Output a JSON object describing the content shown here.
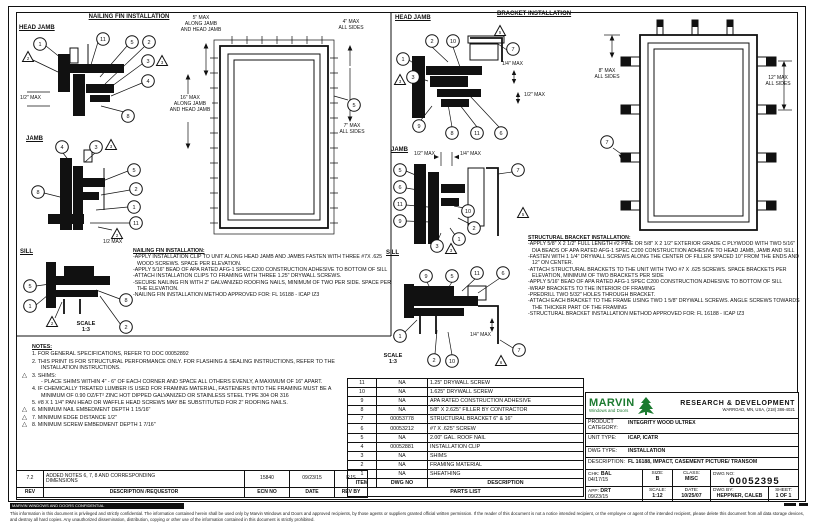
{
  "fin_section": {
    "title": "NAILING FIN INSTALLATION",
    "head_jamb_label": "HEAD JAMB",
    "jamb_label": "JAMB",
    "sill_label": "SILL",
    "scale_text": "SCALE\n1:3",
    "dims": {
      "hj_half": "1/2\" MAX",
      "j_half": "1/2 MAX",
      "elev_top": "5\" MAX\nALONG JAMB\nAND HEAD JAMB",
      "elev_left": "16\" MAX\nALONG JAMB\nAND HEAD JAMB",
      "elev_r1": "4\" MAX\nALL SIDES",
      "elev_r2": "7\" MAX\nALL SIDES"
    },
    "instructions_title": "NAILING FIN INSTALLATION:",
    "instructions": [
      "-APPLY INSTALLATION CLIP TO UNIT ALONG HEAD JAMB AND JAMBS FASTEN WITH THREE #7X .625 WOOD SCREWS. SPACE PER ELEVATION.",
      "-APPLY 5/16\" BEAD OF APA RATED AFG-1 SPEC C200 CONSTRUCTION ADHESIVE TO BOTTOM OF SILL",
      "-ATTACH INSTALLATION CLIPS TO FRAMING WITH THREE 1.25\" DRYWALL SCREWS.",
      "-SECURE NAILING FIN WITH 2\" GALVANIZED ROOFING NAILS, MINIMUM OF TWO PER SIDE. SPACE PER THE ELEVATION.",
      "-NAILING FIN INSTALLATION METHOD APPROVED FOR: FL 16188 - ICAP IZ3"
    ]
  },
  "bracket_section": {
    "title": "BRACKET INSTALLATION",
    "head_jamb_label": "HEAD JAMB",
    "jamb_label": "JAMB",
    "sill_label": "SILL",
    "scale_text": "SCALE\n1:3",
    "dims": {
      "hj_quarter": "1/4\" MAX",
      "hj_half": "1/2\" MAX",
      "j_half": "1/2\" MAX",
      "j_quarter": "1/4\" MAX",
      "s_quarter": "1/4\" MAX",
      "elev_left": "8\" MAX\nALL SIDES",
      "elev_right": "12\" MAX\nALL SIDES"
    },
    "instructions_title": "STRUCTURAL BRACKET INSTALLATION:",
    "instructions": [
      "-APPLY 5/8\" X 2 1/2\" FULL LENGTH #2 PINE OR 5/8\" X 2 1/2\" EXTERIOR GRADE C PLYWOOD WITH TWO 5/16\" DIA BEADS OF APA RATED AFG-1 SPEC C200 CONSTRUCTION ADHESIVE TO HEAD JAMB, JAMB AND SILL",
      "-FASTEN WITH 1 1/4\" DRYWALL SCREWS ALONG THE CENTER OF FILLER SPACED 10\" FROM THE ENDS AND 12\" ON CENTER.",
      "-ATTACH STRUCTURAL BRACKETS TO THE UNIT WITH TWO #7 X .625 SCREWS. SPACE BRACKETS PER ELEVATION, MINIMUM OF TWO BRACKETS PER SIDE",
      "-APPLY 5/16\" BEAD OF APA RATED AFG-1 SPEC C200 CONSTRUCTION ADHESIVE TO BOTTOM OF SILL",
      "-WRAP BRACKETS TO THE INTERIOR OF FRAMING",
      "-PREDRILL TWO 5/32\" HOLES THROUGH BRACKET.",
      "-ATTACH EACH BRACKET TO THE FRAME USING TWO 1 5/8\" DRYWALL SCREWS. ANGLE SCREWS TOWARDS THE THICKER PART OF THE FRAMING",
      "-STRUCTURAL BRACKET INSTALLATION METHOD APPROVED FOR: FL 16188 - ICAP IZ3"
    ]
  },
  "callouts": {
    "fin_head_jamb": [
      "2",
      "1",
      "11",
      "5",
      "2",
      "3",
      "3",
      "4",
      "8"
    ],
    "fin_jamb": [
      "4",
      "3",
      "3",
      "5",
      "2",
      "1",
      "11",
      "8",
      "2"
    ],
    "fin_sill": [
      "5",
      "1",
      "8",
      "2",
      "2"
    ],
    "fin_elev": [
      "5"
    ],
    "brk_head_jamb": [
      "5",
      "2",
      "10",
      "7",
      "1",
      "3",
      "3",
      "9",
      "8",
      "11",
      "6"
    ],
    "brk_jamb": [
      "5",
      "6",
      "11",
      "9",
      "3",
      "3",
      "1",
      "2",
      "10",
      "7",
      "5"
    ],
    "brk_sill": [
      "9",
      "5",
      "11",
      "6",
      "1",
      "2",
      "10",
      "7",
      "6"
    ],
    "brk_elev": [
      "7"
    ]
  },
  "notes": {
    "title": "NOTES:",
    "items": [
      {
        "flag": false,
        "text": "1. FOR GENERAL SPECIFICATIONS, REFER TO DOC 00052892"
      },
      {
        "flag": false,
        "text": "2. THIS PRINT IS FOR STRUCTURAL PERFORMANCE ONLY. FOR FLASHING & SEALING INSTRUCTIONS, REFER TO THE INSTALLATION INSTRUCTIONS."
      },
      {
        "flag": true,
        "text": "3. SHIMS:\n- PLACE SHIMS WITHIN 4\" - 6\" OF EACH CORNER AND SPACE ALL OTHERS EVENLY, A MAXIMUM OF 16\" APART."
      },
      {
        "flag": false,
        "text": "4. IF CHEMICALLY TREATED LUMBER IS USED FOR FRAMING MATERIAL, FASTENERS INTO THE FRAMING MUST BE A MINIMUM OF 0.90 OZ/FT² ZINC HOT DIPPED GALVANIZED OR STAINLESS STEEL TYPE 304 OR 316"
      },
      {
        "flag": false,
        "text": "5. #8 X 1 1/4\" PAN HEAD OR WAFFLE HEAD SCREWS MAY BE SUBSTITUTED FOR 2\" ROOFING NAILS."
      },
      {
        "flag": true,
        "text": "6. MINIMUM NAIL EMBEDMENT DEPTH 1 15/16\""
      },
      {
        "flag": true,
        "text": "7. MINIMUM EDGE DISTANCE 1/2\""
      },
      {
        "flag": true,
        "text": "8. MINIMUM SCREW EMBEDMENT DEPTH 1 7/16\""
      }
    ]
  },
  "parts_list": {
    "title": "PARTS LIST",
    "headers": {
      "item": "ITEM",
      "dwg": "DWG NO",
      "desc": "DESCRIPTION"
    },
    "rows": [
      {
        "item": "11",
        "dwg": "NA",
        "desc": "1.25\" DRYWALL SCREW"
      },
      {
        "item": "10",
        "dwg": "NA",
        "desc": "1.625\" DRYWALL SCREW"
      },
      {
        "item": "9",
        "dwg": "NA",
        "desc": "APA RATED CONSTRUCTION ADHESIVE"
      },
      {
        "item": "8",
        "dwg": "NA",
        "desc": "5/8\" X 2.625\" FILLER BY CONTRACTOR"
      },
      {
        "item": "7",
        "dwg": "00053778",
        "desc": "STRUCTURAL BRACKET 6\" & 16\""
      },
      {
        "item": "6",
        "dwg": "00053212",
        "desc": "#7 X .625\" SCREW"
      },
      {
        "item": "5",
        "dwg": "NA",
        "desc": "2.00\" GAL. ROOF NAIL"
      },
      {
        "item": "4",
        "dwg": "00052881",
        "desc": "INSTALLATION CLIP"
      },
      {
        "item": "3",
        "dwg": "NA",
        "desc": "SHIMS"
      },
      {
        "item": "2",
        "dwg": "NA",
        "desc": "FRAMING MATERIAL"
      },
      {
        "item": "1",
        "dwg": "NA",
        "desc": "SHEATHING"
      }
    ]
  },
  "title_block": {
    "company": {
      "name": "MARVIN",
      "tagline": "Windows and Doors",
      "dept": "RESEARCH & DEVELOPMENT",
      "address": "WARROAD, MN, USA, (218) 386-4021"
    },
    "product_label": "PRODUCT\nCATEGORY:",
    "product": "INTEGRITY WOOD ULTREX",
    "unit_label": "UNIT TYPE:",
    "unit": "ICAP, ICATR",
    "dwg_type_label": "DWG TYPE:",
    "dwg_type": "INSTALLATION",
    "desc_label": "DESCRIPTION:",
    "desc": "FL 16188, IMPACT, CASEMENT PICTURE/ TRANSOM",
    "chk_label": "CHK:",
    "chk": "BAL",
    "chk_date": "04/17/15",
    "size_label": "SIZE:",
    "size": "B",
    "class_label": "CLASS:",
    "class": "MISC",
    "dwgno_label": "DWG NO:",
    "dwgno": "00052395",
    "app_label": "APP:",
    "app": "DRT",
    "app_date": "09/23/15",
    "scale_label": "SCALE:",
    "scale": "1:12",
    "date_label": "DATE:",
    "date": "10/25/07",
    "by_label": "DWG BY:",
    "by": "HEPPNER, CALEB",
    "sheet_label": "SHEET:",
    "sheet": "1 OF 1"
  },
  "revision": {
    "rev": "7.2",
    "desc": "ADDED NOTES 6, 7, 8 AND CORRESPONDING\nDIMENSIONS",
    "ecn": "15840",
    "date": "09/23/15",
    "by": "RJS",
    "h_rev": "REV",
    "h_desc": "DESCRIPTION /REQUESTOR",
    "h_ecn": "ECN NO",
    "h_date": "DATE",
    "h_by": "REV BY"
  },
  "disclaimer": {
    "bar": "MARVIN WINDOWS AND DOORS CONFIDENTIAL",
    "text": "This information in this document is privileged and strictly confidential.  The information contained herein shall be used only by Marvin Windows and Doors and approved recipients, by those agents or suppliers granted official written permission.  If the reader of this document is not a notice intended recipient, or the employee or agent of the intended recipient, please delete this document from all data storage devices, and destroy all hard copies.  Any unauthorized dissemination, distribution, copying or other use of the information contained in this document is strictly prohibited."
  }
}
